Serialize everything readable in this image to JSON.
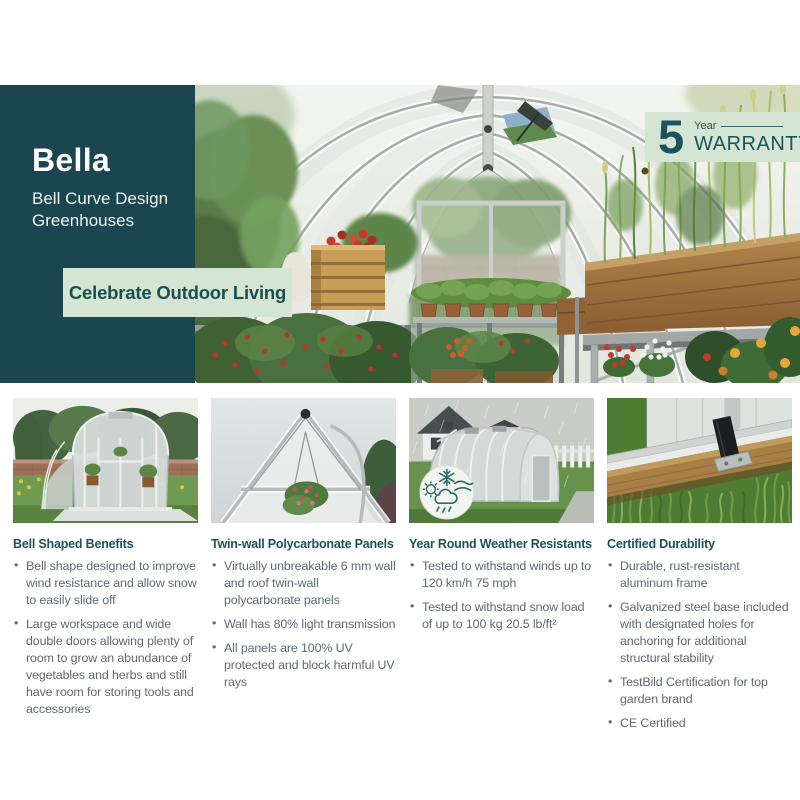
{
  "colors": {
    "teal_panel": "#1b4650",
    "light_green": "#d4e6d3",
    "heading_teal": "#1c525c",
    "body_gray": "#5d6a70"
  },
  "hero": {
    "title": "Bella",
    "subtitle_line1": "Bell Curve Design",
    "subtitle_line2": "Greenhouses",
    "tagline": "Celebrate Outdoor Living",
    "warranty": {
      "number": "5",
      "unit": "Year",
      "label": "WARRANTY"
    }
  },
  "icons": {
    "weather_badge": [
      "snowflake-icon",
      "sun-icon",
      "wind-icon",
      "rain-cloud-icon"
    ]
  },
  "features": [
    {
      "title": "Bell Shaped Benefits",
      "bullets": [
        "Bell shape designed to improve wind resistance and allow snow to easily slide off",
        "Large workspace and wide double doors allowing plenty of room to grow an abundance of vegetables and herbs and still have room for storing tools and accessories"
      ]
    },
    {
      "title": "Twin-wall Polycarbonate Panels",
      "bullets": [
        "Virtually unbreakable 6 mm wall and roof twin-wall polycarbonate panels",
        "Wall has 80% light transmission",
        "All panels are 100% UV protected and block harmful UV rays"
      ]
    },
    {
      "title": "Year Round Weather Resistants",
      "bullets": [
        "Tested to withstand winds up to 120 km/h 75 mph",
        "Tested to withstand snow load of up to 100 kg 20.5 lb/ft²"
      ]
    },
    {
      "title": "Certified Durability",
      "bullets": [
        "Durable, rust-resistant aluminum frame",
        "Galvanized steel base included with designated holes for anchoring for additional structural stability",
        "TestBild Certification for top garden brand",
        "CE Certified"
      ]
    }
  ]
}
